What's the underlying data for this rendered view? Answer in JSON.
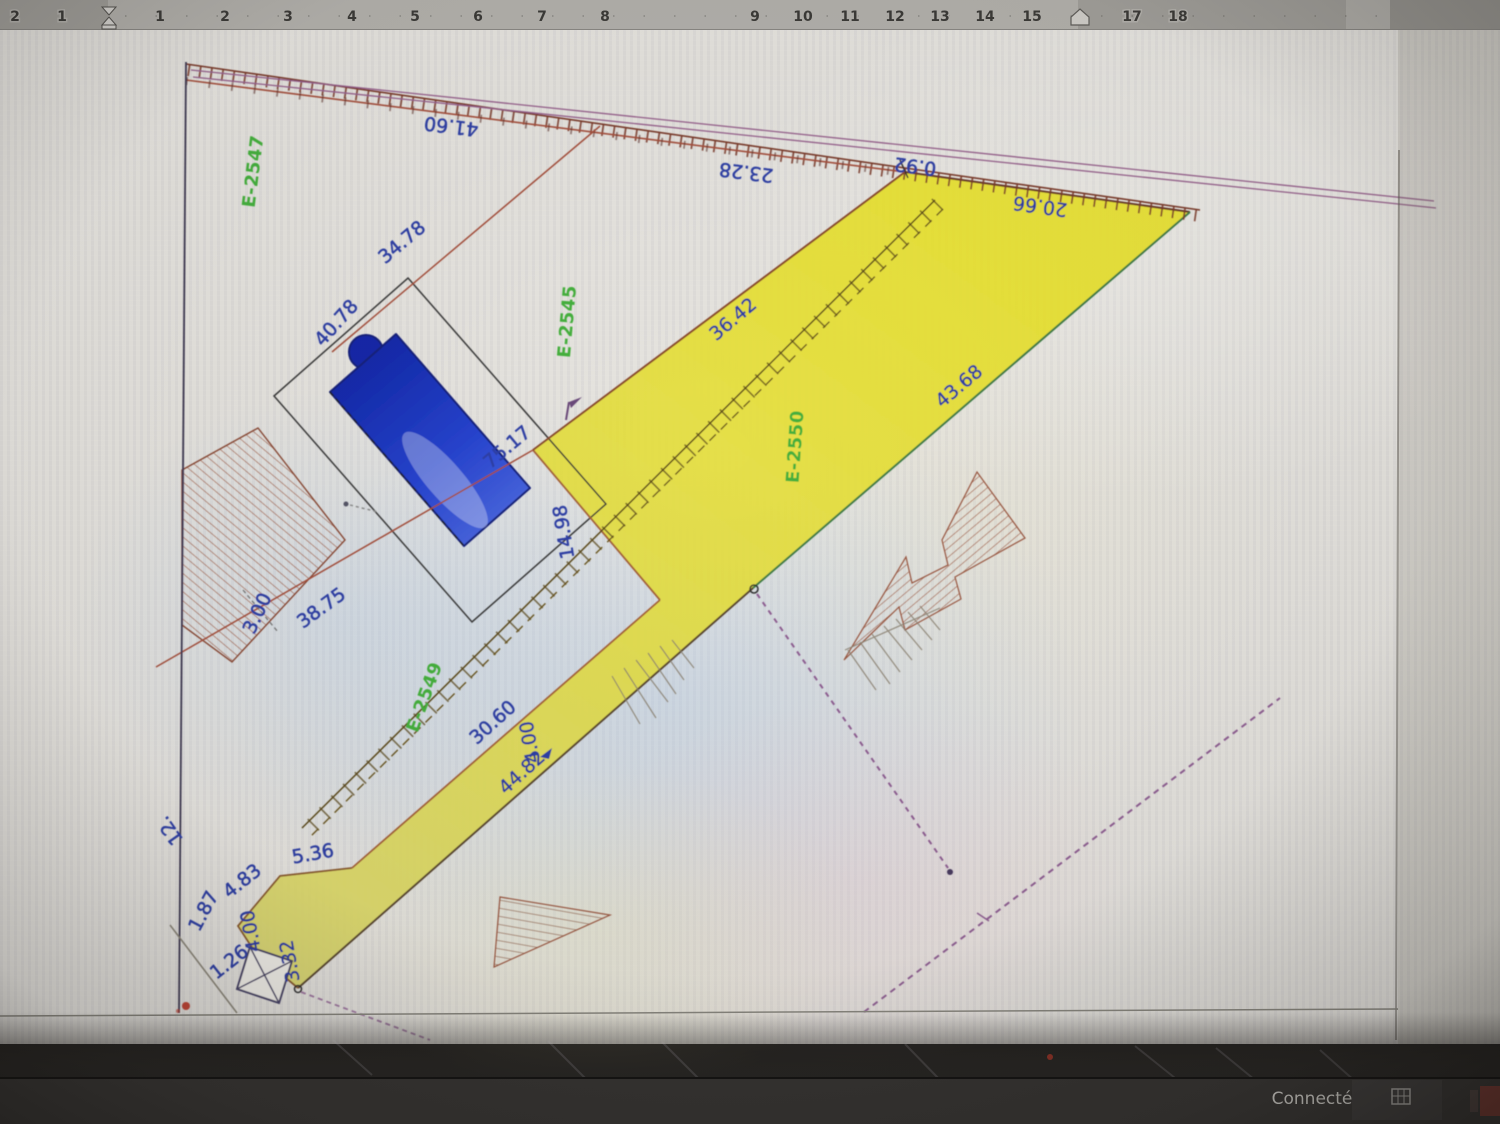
{
  "ruler": {
    "numbers": [
      "2",
      "1",
      "1",
      "2",
      "3",
      "4",
      "5",
      "6",
      "7",
      "8",
      "9",
      "10",
      "11",
      "12",
      "13",
      "14",
      "15",
      "17",
      "18"
    ]
  },
  "plan": {
    "parcels": [
      {
        "id": "E-2547"
      },
      {
        "id": "E-2545"
      },
      {
        "id": "E-2550"
      },
      {
        "id": "E-2549"
      }
    ],
    "dimensions": [
      {
        "text": "41.60"
      },
      {
        "text": "23.28"
      },
      {
        "text": "0.92"
      },
      {
        "text": "20.66"
      },
      {
        "text": "34.78"
      },
      {
        "text": "40.78"
      },
      {
        "text": "36.42"
      },
      {
        "text": "43.68"
      },
      {
        "text": "75.17"
      },
      {
        "text": "14.98"
      },
      {
        "text": "38.75"
      },
      {
        "text": "3.00"
      },
      {
        "text": "30.60"
      },
      {
        "text": "4.00"
      },
      {
        "text": "44.82"
      },
      {
        "text": "5.36"
      },
      {
        "text": "4.83"
      },
      {
        "text": "1.87"
      },
      {
        "text": "4.00"
      },
      {
        "text": "1.26"
      },
      {
        "text": "3.32"
      },
      {
        "text": "12."
      }
    ],
    "colors": {
      "highlight_parcel_fill": "#e6df45",
      "parcel_label_green": "#45b03c",
      "dimension_blue": "#2e3fa5",
      "boundary_red": "#a5503c",
      "road_purple": "#96608c",
      "pool_blue": "#1c34bd"
    }
  },
  "statusbar": {
    "connected_label": "Connecté"
  }
}
